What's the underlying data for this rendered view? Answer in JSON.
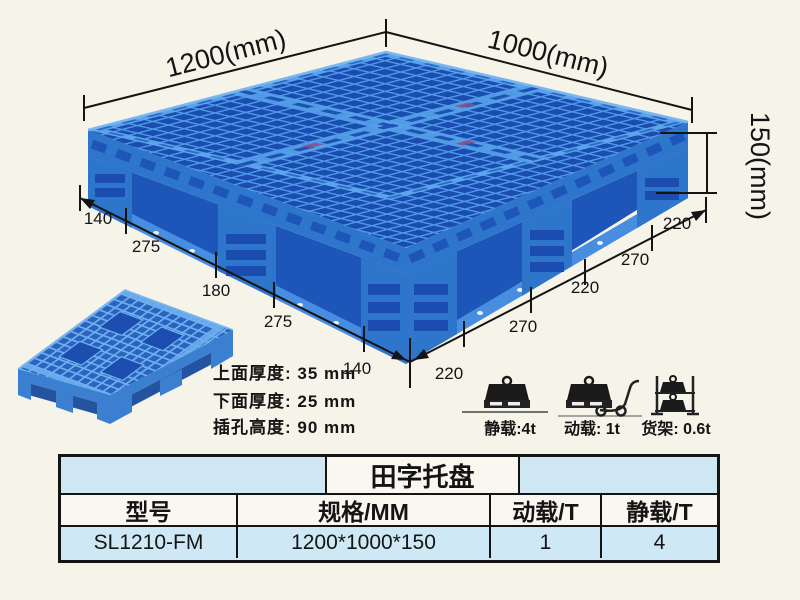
{
  "annotations": {
    "dim_top_left": "1200(mm)",
    "dim_top_right": "1000(mm)",
    "dim_height": "150(mm)",
    "left_edge_dims": [
      "140",
      "275",
      "180",
      "275",
      "140"
    ],
    "right_edge_dims": [
      "220",
      "270",
      "220",
      "270",
      "220"
    ],
    "thickness_notes": [
      "上面厚度: 35 mm",
      "下面厚度: 25 mm",
      "插孔高度: 90 mm"
    ],
    "load_ratings": [
      {
        "icon": "static-load-weight-icon",
        "label": "静载:4t"
      },
      {
        "icon": "dynamic-load-trolley-icon",
        "label": "动载: 1t"
      },
      {
        "icon": "rack-load-shelf-icon",
        "label": "货架: 0.6t"
      }
    ]
  },
  "table": {
    "title": "田字托盘",
    "headers": [
      "型号",
      "规格/MM",
      "动载/T",
      "静载/T"
    ],
    "rows": [
      [
        "SL1210-FM",
        "1200*1000*150",
        "1",
        "4"
      ]
    ]
  },
  "colors": {
    "pallet_blue": "#2e76cc",
    "pallet_dark_blue": "#1b4db1",
    "pallet_light_blue": "#57a2e9",
    "table_light_blue": "#cfe6f3",
    "background": "#f6f3e9",
    "ink": "#141414"
  }
}
